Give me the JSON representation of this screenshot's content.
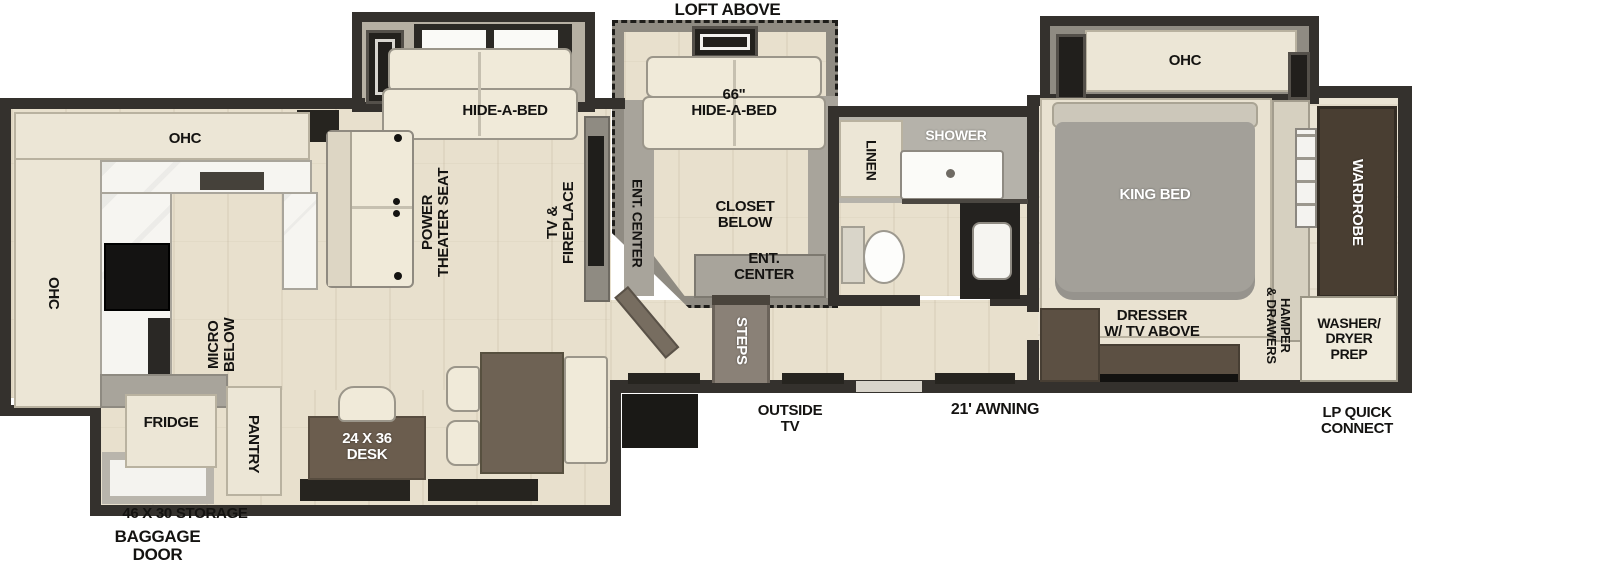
{
  "colors": {
    "wall": "#34312d",
    "floor_wood": "#e8e0cd",
    "cabinet_cream": "#ece6d6",
    "counter_white": "#f6f5f1",
    "slide_gray": "#8f8b82",
    "sofa_white": "#f0ead9",
    "bed_gray": "#a3a099",
    "wardrobe_brown": "#493e32",
    "furniture_brown": "#5c5043",
    "desk_brown": "#6b5d4e",
    "shower_gray": "#b5b2aa",
    "steps_gray": "#8a8177",
    "appliance_black": "#1a1916",
    "label_black": "#141311",
    "label_white": "#ffffff"
  },
  "labels": {
    "loft_above": "LOFT ABOVE",
    "living": {
      "hide_a_bed": "HIDE-A-BED",
      "power_theater_seat": "POWER\nTHEATER SEAT",
      "tv_fireplace": "TV &\nFIREPLACE"
    },
    "loft": {
      "hide_a_bed_66": "66\"\nHIDE-A-BED",
      "ent_center_side": "ENT. CENTER",
      "closet_below": "CLOSET\nBELOW",
      "ent_center": "ENT.\nCENTER"
    },
    "kitchen": {
      "ohc_top": "OHC",
      "ohc_left": "OHC",
      "micro_below": "MICRO\nBELOW",
      "fridge": "FRIDGE",
      "pantry": "PANTRY",
      "desk": "24 X 36\nDESK"
    },
    "bath": {
      "linen": "LINEN",
      "shower": "SHOWER"
    },
    "bedroom": {
      "ohc": "OHC",
      "king_bed": "KING BED",
      "wardrobe": "WARDROBE",
      "hamper_drawers": "HAMPER\n& DRAWERS",
      "washer_dryer_prep": "WASHER/\nDRYER\nPREP",
      "dresser_tv": "DRESSER\nW/ TV ABOVE"
    },
    "entry": {
      "steps": "STEPS",
      "outside_tv": "OUTSIDE\nTV",
      "awning": "21' AWNING"
    },
    "exterior": {
      "lp_quick_connect": "LP QUICK\nCONNECT",
      "storage": "46 X 30 STORAGE",
      "baggage_door": "BAGGAGE\nDOOR"
    }
  }
}
